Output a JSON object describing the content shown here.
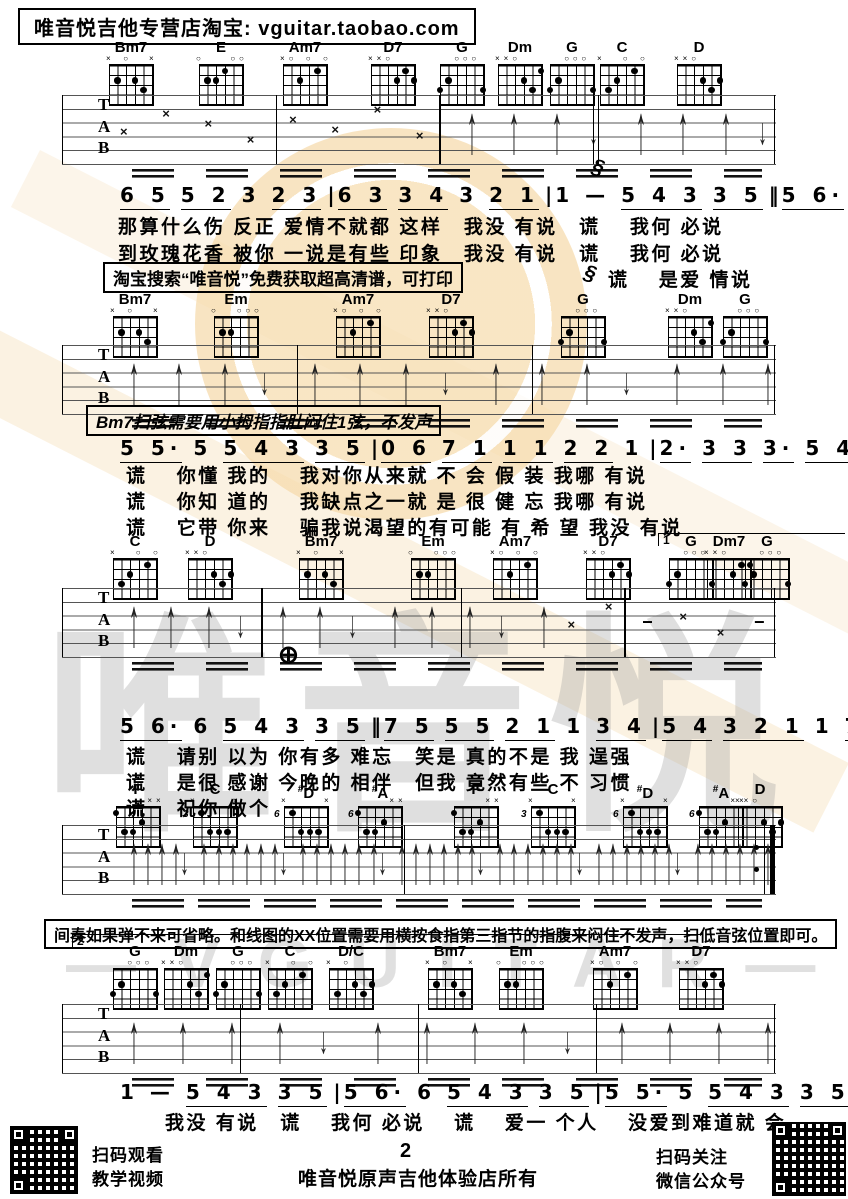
{
  "banner": {
    "text": "唯音悦吉他专营店淘宝: vguitar.taobao.com"
  },
  "page_number": "2",
  "watermark": {
    "brand": "唯音悦",
    "brand_latin": "— V G U I T A R —"
  },
  "notes": {
    "note1": "淘宝搜索“唯音悦”免费获取超高清谱，可打印",
    "note2": "Bm7扫弦需要用小拇指指肚闷住1弦，不发声",
    "note3": "间奏如果弹不来可省略。和线图的XX位置需要用横按食指第三指节的指腹来闷住不发声，扫低音弦位置即可。"
  },
  "marks": {
    "segno": "§",
    "coda": "⊕",
    "volta1": "1",
    "volta2": "2"
  },
  "staff_letters": [
    "T",
    "A",
    "B"
  ],
  "chord_shapes": {
    "Bm7": {
      "markers": "x_o__x",
      "dots": [
        [
          2,
          2
        ],
        [
          4,
          2
        ],
        [
          5,
          3
        ]
      ]
    },
    "E": {
      "markers": "o___oo",
      "dots": [
        [
          2,
          2
        ],
        [
          3,
          2
        ],
        [
          4,
          1
        ]
      ]
    },
    "Am7": {
      "markers": "xo_o_o",
      "dots": [
        [
          3,
          2
        ],
        [
          5,
          1
        ]
      ]
    },
    "D7": {
      "markers": "xxo___",
      "dots": [
        [
          4,
          2
        ],
        [
          5,
          1
        ],
        [
          6,
          2
        ]
      ]
    },
    "G": {
      "markers": "__ooo_",
      "dots": [
        [
          1,
          3
        ],
        [
          2,
          2
        ],
        [
          6,
          3
        ]
      ]
    },
    "Dm": {
      "markers": "xxo___",
      "dots": [
        [
          4,
          2
        ],
        [
          5,
          3
        ],
        [
          6,
          1
        ]
      ]
    },
    "C": {
      "markers": "x__o_o",
      "dots": [
        [
          2,
          3
        ],
        [
          3,
          2
        ],
        [
          5,
          1
        ]
      ]
    },
    "D": {
      "markers": "xxo___",
      "dots": [
        [
          4,
          2
        ],
        [
          5,
          3
        ],
        [
          6,
          2
        ]
      ]
    },
    "Em": {
      "markers": "o__ooo",
      "dots": [
        [
          2,
          2
        ],
        [
          3,
          2
        ]
      ]
    },
    "Dm7": {
      "markers": "xxo___",
      "dots": [
        [
          4,
          2
        ],
        [
          5,
          1
        ],
        [
          6,
          1
        ]
      ]
    },
    "F": {
      "markers": "____xx",
      "dots": [
        [
          1,
          1
        ],
        [
          2,
          3
        ],
        [
          3,
          3
        ],
        [
          4,
          2
        ]
      ]
    },
    "C3": {
      "markers": "x____x",
      "dots": [
        [
          2,
          1
        ],
        [
          3,
          3
        ],
        [
          4,
          3
        ],
        [
          5,
          3
        ]
      ],
      "fret": "3"
    },
    "Ds6": {
      "markers": "x____x",
      "dots": [
        [
          2,
          1
        ],
        [
          3,
          3
        ],
        [
          4,
          3
        ],
        [
          5,
          3
        ]
      ],
      "fret": "6"
    },
    "As6": {
      "markers": "____xx",
      "dots": [
        [
          1,
          1
        ],
        [
          2,
          3
        ],
        [
          3,
          3
        ],
        [
          4,
          2
        ]
      ],
      "fret": "6"
    },
    "DC": {
      "markers": "x_o___",
      "dots": [
        [
          2,
          3
        ],
        [
          4,
          2
        ],
        [
          5,
          3
        ],
        [
          6,
          2
        ]
      ]
    }
  },
  "chord_rows": [
    {
      "chords": [
        {
          "name": "Bm7",
          "shape": "Bm7",
          "x": 133
        },
        {
          "name": "E",
          "shape": "E",
          "x": 223
        },
        {
          "name": "Am7",
          "shape": "Am7",
          "x": 307
        },
        {
          "name": "D7",
          "shape": "D7",
          "x": 395
        },
        {
          "name": "G",
          "shape": "G",
          "x": 464
        },
        {
          "name": "Dm",
          "shape": "Dm",
          "x": 522
        },
        {
          "name": "G",
          "shape": "G",
          "x": 574
        },
        {
          "name": "C",
          "shape": "C",
          "x": 624
        },
        {
          "name": "D",
          "shape": "D",
          "x": 701
        }
      ]
    },
    {
      "chords": [
        {
          "name": "Bm7",
          "shape": "Bm7",
          "x": 137
        },
        {
          "name": "Em",
          "shape": "Em",
          "x": 238
        },
        {
          "name": "Am7",
          "shape": "Am7",
          "x": 360
        },
        {
          "name": "D7",
          "shape": "D7",
          "x": 453
        },
        {
          "name": "G",
          "shape": "G",
          "x": 585
        },
        {
          "name": "Dm",
          "shape": "Dm",
          "x": 692
        },
        {
          "name": "G",
          "shape": "G",
          "x": 747
        }
      ]
    },
    {
      "chords": [
        {
          "name": "C",
          "shape": "C",
          "x": 137
        },
        {
          "name": "D",
          "shape": "D",
          "x": 212
        },
        {
          "name": "Bm7",
          "shape": "Bm7",
          "x": 323
        },
        {
          "name": "Em",
          "shape": "Em",
          "x": 435
        },
        {
          "name": "Am7",
          "shape": "Am7",
          "x": 517
        },
        {
          "name": "D7",
          "shape": "D7",
          "x": 610
        },
        {
          "name": "G",
          "shape": "G",
          "x": 693
        },
        {
          "name": "Dm7",
          "shape": "Dm7",
          "x": 731
        },
        {
          "name": "G",
          "shape": "G",
          "x": 769
        }
      ]
    },
    {
      "chords": [
        {
          "name": "F",
          "shape": "F",
          "x": 140
        },
        {
          "name": "C",
          "shape": "C3",
          "x": 217
        },
        {
          "name": "#D",
          "shape": "Ds6",
          "x": 308
        },
        {
          "name": "#A",
          "shape": "As6",
          "x": 382
        },
        {
          "name": "F",
          "shape": "F",
          "x": 478
        },
        {
          "name": "C",
          "shape": "C3",
          "x": 555
        },
        {
          "name": "#D",
          "shape": "Ds6",
          "x": 647
        },
        {
          "name": "#A",
          "shape": "As6",
          "x": 723
        },
        {
          "name": "D",
          "shape": "D",
          "x": 762
        }
      ]
    },
    {
      "chords": [
        {
          "name": "G",
          "shape": "G",
          "x": 137
        },
        {
          "name": "Dm",
          "shape": "Dm",
          "x": 188
        },
        {
          "name": "G",
          "shape": "G",
          "x": 240
        },
        {
          "name": "C",
          "shape": "C",
          "x": 292
        },
        {
          "name": "D/C",
          "shape": "DC",
          "x": 353
        },
        {
          "name": "Bm7",
          "shape": "Bm7",
          "x": 452
        },
        {
          "name": "Em",
          "shape": "Em",
          "x": 523
        },
        {
          "name": "Am7",
          "shape": "Am7",
          "x": 617
        },
        {
          "name": "D7",
          "shape": "D7",
          "x": 703
        }
      ]
    }
  ],
  "staves": [
    {
      "glyphs": [
        "×",
        "×",
        "×",
        "×",
        "×",
        "×",
        "×",
        "×",
        "↑",
        "↑",
        "↑",
        "↓",
        "↑",
        "↑",
        "↑",
        "↓"
      ]
    },
    {
      "glyphs": [
        "↑",
        "↑",
        "↑",
        "↓",
        "↑",
        "↑",
        "↑",
        "↓",
        "↑",
        "↑",
        "↑",
        "↓",
        "↑",
        "↑",
        "↑"
      ]
    },
    {
      "glyphs": [
        "↑",
        "↑",
        "↑",
        "↓",
        "↑",
        "↑",
        "↓",
        "↑",
        "↑",
        "↑",
        "↓",
        "↑",
        "×",
        "×",
        "−",
        "×",
        "×",
        "−"
      ]
    },
    {
      "glyphs": [
        "↑",
        "↑",
        "↑",
        "↑",
        "↓",
        "↑",
        "↑",
        "↑",
        "↑",
        "↑",
        "↑",
        "↓",
        "↑",
        "↑",
        "↑",
        "↑",
        "↑",
        "↑",
        "↓",
        "↑",
        "↑",
        "↑",
        "↑",
        "↑",
        "↑",
        "↓",
        "↑",
        "↑",
        "↑",
        "↑",
        "↑",
        "↑",
        "↓",
        "↑",
        "↑",
        "↑",
        "↑",
        "↑",
        "↑",
        "↓",
        "↑",
        "↑",
        "↑",
        "↑",
        "↑",
        "↑"
      ]
    },
    {
      "glyphs": [
        "↑",
        "↑",
        "↑",
        "↑",
        "↓",
        "↑",
        "↑",
        "↑",
        "↑",
        "↓",
        "↑",
        "↑",
        "↑",
        "↑"
      ]
    }
  ],
  "melody_lines": [
    {
      "segments": [
        [
          "6 5",
          "u"
        ],
        [
          "5 2",
          "u"
        ],
        [
          "3",
          ""
        ],
        [
          "2 3",
          "u"
        ],
        [
          "|",
          ""
        ],
        [
          "6 3",
          "u"
        ],
        [
          "3 4",
          "u"
        ],
        [
          "3",
          ""
        ],
        [
          "2 1",
          "u"
        ],
        [
          "|",
          ""
        ],
        [
          "1",
          ""
        ],
        [
          "—",
          ""
        ],
        [
          "5 4 3",
          "u"
        ],
        [
          "3 5",
          "u"
        ],
        [
          "‖",
          ""
        ],
        [
          "5 6·",
          "u"
        ],
        [
          "6",
          ""
        ],
        [
          "5 4 3",
          "u"
        ],
        [
          "3 5",
          "u"
        ],
        [
          "|",
          ""
        ]
      ]
    },
    {
      "segments": [
        [
          "5 5·",
          "u"
        ],
        [
          "5",
          ""
        ],
        [
          "5 4 3",
          "u"
        ],
        [
          "3 5",
          "u"
        ],
        [
          "|",
          ""
        ],
        [
          "0 6",
          "u"
        ],
        [
          "7 1",
          "u"
        ],
        [
          "1 1",
          "u"
        ],
        [
          "2 2",
          "u"
        ],
        [
          "1",
          ""
        ],
        [
          "|",
          ""
        ],
        [
          "2·",
          "u"
        ],
        [
          "3 3",
          "u"
        ],
        [
          "3·",
          "u"
        ],
        [
          "5 4 3",
          "u"
        ],
        [
          "3 5",
          "u"
        ],
        [
          "|",
          ""
        ]
      ]
    },
    {
      "segments": [
        [
          "5 6·",
          "u"
        ],
        [
          "6",
          ""
        ],
        [
          "5 4 3",
          "u"
        ],
        [
          "3 5",
          "u"
        ],
        [
          "‖",
          ""
        ],
        [
          "7 5",
          "u"
        ],
        [
          "5 5",
          "u"
        ],
        [
          "2 1",
          "u"
        ],
        [
          "1",
          ""
        ],
        [
          "3 4",
          "u"
        ],
        [
          "|",
          ""
        ],
        [
          "5 4",
          "u"
        ],
        [
          "3 2 1",
          "u"
        ],
        [
          "1",
          ""
        ],
        [
          "7 1",
          "u"
        ],
        [
          "|",
          ""
        ],
        [
          "1",
          ""
        ],
        [
          "—",
          ""
        ],
        [
          "0 0",
          ""
        ],
        [
          "|",
          ""
        ]
      ]
    },
    {
      "segments": [
        [
          "1",
          ""
        ],
        [
          "—",
          ""
        ],
        [
          "5 4 3",
          "u"
        ],
        [
          "3 5",
          "u"
        ],
        [
          "|",
          ""
        ],
        [
          "5 6·",
          "u"
        ],
        [
          "6",
          ""
        ],
        [
          "5 4 3",
          "u"
        ],
        [
          "3 5",
          "u"
        ],
        [
          "|",
          ""
        ],
        [
          "5 5·",
          "u"
        ],
        [
          "5",
          ""
        ],
        [
          "5 4 3",
          "u"
        ],
        [
          "3 5",
          "u"
        ],
        [
          "|",
          ""
        ],
        [
          "0 6",
          "u"
        ],
        [
          "7 1",
          "u"
        ],
        [
          "1 1",
          "u"
        ],
        [
          "2 2",
          "u"
        ],
        [
          "1",
          ""
        ],
        [
          "|",
          ""
        ]
      ]
    }
  ],
  "lyrics": [
    "那算什么伤 反正 爱情不就都 这样　我没 有说　谎　 我何 必说",
    "到玫瑰花香 被你 一说是有些 印象　我没 有说　谎　 我何 必说",
    "谎　 是爱 情说",
    "谎　 你懂 我的　 我对你从来就 不 会 假 装 我哪 有说",
    "谎　 你知 道的　 我缺点之一就 是 很 健 忘 我哪 有说",
    "谎　 它带 你来　 骗我说渴望的有可能 有 希 望 我没 有说",
    "谎　 请别 以为 你有多 难忘　笑是 真的不是 我 逞强",
    "谎　 是很 感谢 今晚的 相伴　但我 竟然有些 不 习惯",
    "谎　 祝你 做个",
    "我没 有说　谎　 我何 必说　 谎　 爱一 个人　 没爱到难道就 会"
  ],
  "footer": {
    "left_caption_line1": "扫码观看",
    "left_caption_line2": "教学视频",
    "center": "唯音悦原声吉他体验店所有",
    "right_caption_line1": "扫码关注",
    "right_caption_line2": "微信公众号"
  }
}
